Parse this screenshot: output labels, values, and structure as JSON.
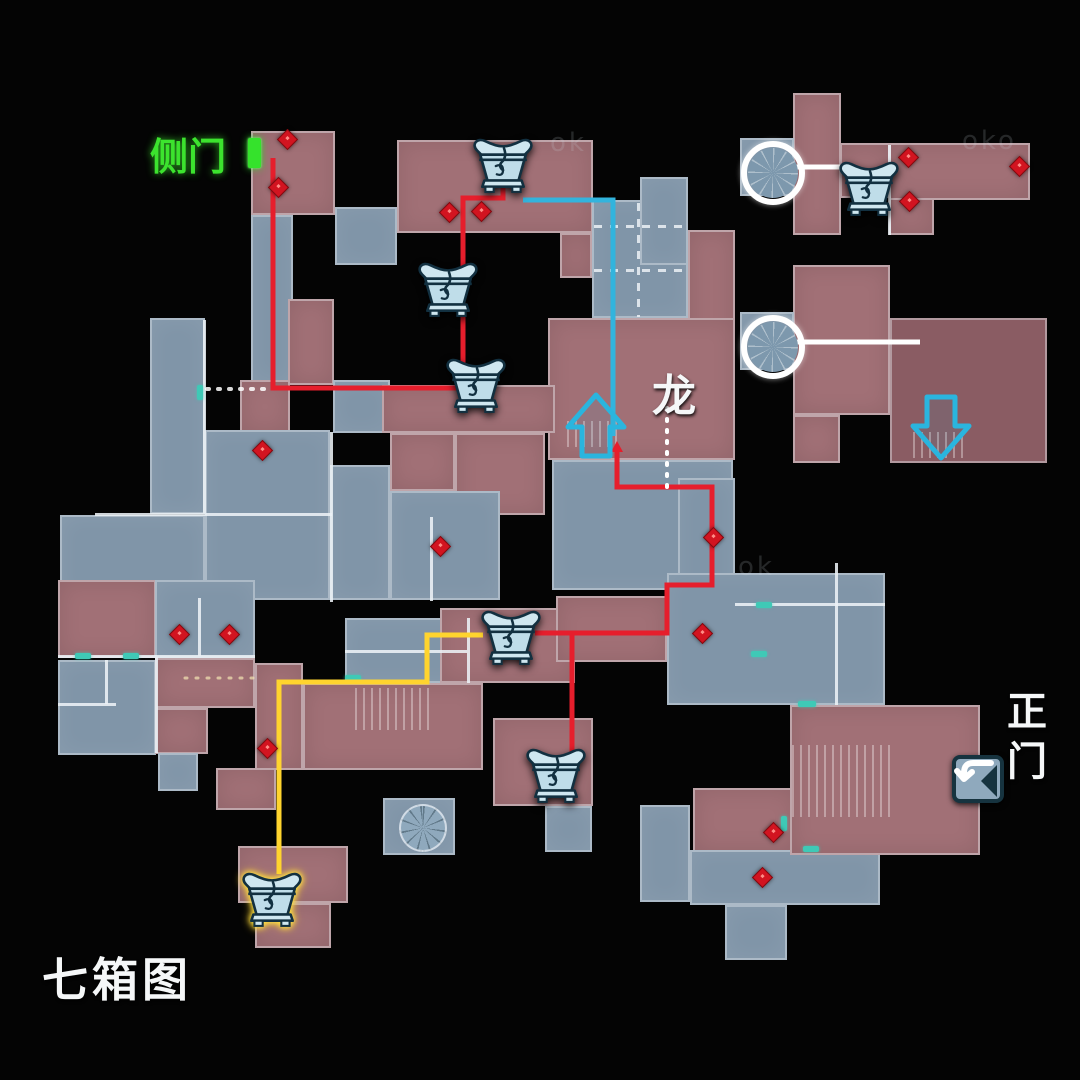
{
  "map": {
    "title": "七箱图",
    "labels": {
      "side_door": "侧门",
      "dragon": "龙",
      "main_gate": "正门"
    },
    "watermarks": [
      {
        "t": "oko",
        "x": 962,
        "y": 126
      },
      {
        "t": "ok",
        "x": 738,
        "y": 552
      },
      {
        "t": "ok",
        "x": 550,
        "y": 128
      }
    ],
    "colors": {
      "room_blue": "#8095a8",
      "room_red": "#a17076",
      "room_dark_red": "#8a5c63",
      "route_red": "#e61e2c",
      "route_yellow": "#ffd42e",
      "route_cyan": "#32b4dd",
      "route_white": "#ffffff",
      "door_green": "#35e22c",
      "marker_red": "#d21420",
      "door_teal": "#3fc9b6"
    },
    "rooms": [
      [
        251,
        131,
        84,
        84,
        "r"
      ],
      [
        251,
        215,
        42,
        168,
        "b"
      ],
      [
        288,
        299,
        46,
        86,
        "r"
      ],
      [
        335,
        207,
        62,
        58,
        "b"
      ],
      [
        150,
        318,
        55,
        196,
        "b"
      ],
      [
        240,
        380,
        50,
        53,
        "r"
      ],
      [
        333,
        380,
        57,
        53,
        "b"
      ],
      [
        397,
        140,
        196,
        93,
        "r"
      ],
      [
        560,
        233,
        32,
        45,
        "r"
      ],
      [
        592,
        200,
        96,
        118,
        "b"
      ],
      [
        640,
        177,
        48,
        88,
        "b"
      ],
      [
        688,
        230,
        47,
        118,
        "r"
      ],
      [
        548,
        318,
        187,
        142,
        "r"
      ],
      [
        382,
        385,
        173,
        48,
        "r"
      ],
      [
        390,
        433,
        65,
        58,
        "r"
      ],
      [
        455,
        433,
        90,
        82,
        "r"
      ],
      [
        205,
        430,
        125,
        170,
        "b"
      ],
      [
        330,
        465,
        60,
        135,
        "b"
      ],
      [
        390,
        491,
        110,
        109,
        "b"
      ],
      [
        60,
        515,
        145,
        85,
        "b"
      ],
      [
        552,
        460,
        181,
        130,
        "b"
      ],
      [
        678,
        478,
        57,
        127,
        "b"
      ],
      [
        667,
        573,
        218,
        132,
        "b"
      ],
      [
        58,
        580,
        98,
        78,
        "r"
      ],
      [
        155,
        580,
        100,
        78,
        "b"
      ],
      [
        58,
        660,
        98,
        95,
        "b"
      ],
      [
        155,
        658,
        100,
        50,
        "r"
      ],
      [
        155,
        708,
        53,
        46,
        "r"
      ],
      [
        255,
        663,
        48,
        107,
        "r"
      ],
      [
        158,
        753,
        40,
        38,
        "b"
      ],
      [
        345,
        618,
        122,
        65,
        "b"
      ],
      [
        440,
        608,
        135,
        75,
        "r"
      ],
      [
        556,
        596,
        111,
        66,
        "r"
      ],
      [
        303,
        683,
        180,
        87,
        "r"
      ],
      [
        216,
        768,
        60,
        42,
        "r"
      ],
      [
        383,
        798,
        72,
        57,
        "b"
      ],
      [
        493,
        718,
        100,
        88,
        "r"
      ],
      [
        545,
        806,
        47,
        46,
        "b"
      ],
      [
        640,
        805,
        50,
        97,
        "b"
      ],
      [
        693,
        788,
        103,
        64,
        "r"
      ],
      [
        690,
        850,
        190,
        55,
        "b"
      ],
      [
        725,
        905,
        62,
        55,
        "b"
      ],
      [
        790,
        705,
        190,
        150,
        "r"
      ],
      [
        793,
        93,
        48,
        142,
        "r"
      ],
      [
        840,
        143,
        50,
        55,
        "r"
      ],
      [
        889,
        143,
        141,
        57,
        "r"
      ],
      [
        889,
        198,
        45,
        37,
        "r"
      ],
      [
        793,
        265,
        97,
        150,
        "r"
      ],
      [
        793,
        415,
        47,
        48,
        "r"
      ],
      [
        890,
        318,
        157,
        145,
        "d"
      ],
      [
        740,
        138,
        54,
        58,
        "b"
      ],
      [
        740,
        312,
        54,
        58,
        "b"
      ],
      [
        238,
        846,
        110,
        57,
        "r"
      ],
      [
        255,
        903,
        76,
        45,
        "r"
      ]
    ],
    "walls": [
      [
        95,
        513,
        237,
        3
      ],
      [
        203,
        320,
        3,
        193
      ],
      [
        330,
        432,
        3,
        170
      ],
      [
        58,
        655,
        197,
        3
      ],
      [
        198,
        598,
        3,
        58
      ],
      [
        155,
        657,
        3,
        96
      ],
      [
        430,
        517,
        3,
        84
      ],
      [
        58,
        703,
        58,
        3
      ],
      [
        105,
        660,
        3,
        44
      ],
      [
        735,
        603,
        150,
        3
      ],
      [
        835,
        563,
        3,
        142
      ],
      [
        888,
        145,
        3,
        90
      ],
      [
        345,
        650,
        122,
        3
      ],
      [
        467,
        618,
        3,
        65
      ]
    ],
    "dashed_walls_h": [
      [
        594,
        225,
        92,
        3
      ],
      [
        594,
        269,
        92,
        3
      ]
    ],
    "dashed_walls_v": [
      [
        637,
        203,
        3,
        114
      ]
    ],
    "ladders": [
      [
        355,
        688,
        78,
        42
      ],
      [
        567,
        421,
        50,
        26
      ],
      [
        913,
        432,
        54,
        26
      ],
      [
        792,
        745,
        100,
        72
      ]
    ],
    "teal_doors": [
      [
        75,
        653,
        16,
        6
      ],
      [
        123,
        653,
        16,
        6
      ],
      [
        197,
        385,
        6,
        15
      ],
      [
        345,
        675,
        16,
        6
      ],
      [
        756,
        602,
        16,
        6
      ],
      [
        751,
        651,
        16,
        6
      ],
      [
        798,
        701,
        18,
        6
      ],
      [
        781,
        816,
        6,
        15
      ],
      [
        803,
        846,
        16,
        6
      ]
    ],
    "diamonds": [
      [
        287,
        139
      ],
      [
        278,
        187
      ],
      [
        449,
        212
      ],
      [
        481,
        211
      ],
      [
        908,
        157
      ],
      [
        1019,
        166
      ],
      [
        909,
        201
      ],
      [
        262,
        450
      ],
      [
        440,
        546
      ],
      [
        179,
        634
      ],
      [
        229,
        634
      ],
      [
        713,
        537
      ],
      [
        702,
        633
      ],
      [
        773,
        832
      ],
      [
        762,
        877
      ],
      [
        267,
        748
      ]
    ],
    "routes": {
      "red_a": "M273,158 L273,388 L480,388 M463,388 L463,198 L503,198 L503,170",
      "red_b": "M617,448 L617,487 L712,487 L712,585 L667,585 L667,633 L535,633 M572,633 L572,758",
      "yellow": "M483,635 L427,635 L427,682 L279,682 L279,874",
      "cyan": "M523,200 L613,200 L613,436",
      "white_1": "M792,167 L853,167",
      "white_2": "M792,342 L920,342",
      "dotted_1": "M667,408 L667,492",
      "dotted_2": "M207,389 L264,389",
      "dotted_3": "M185,678 L256,678"
    },
    "red_arrowhead_points": "611,452 623,452 617,441",
    "chests": [
      {
        "x": 503,
        "y": 167,
        "hl": false
      },
      {
        "x": 448,
        "y": 291,
        "hl": false
      },
      {
        "x": 476,
        "y": 387,
        "hl": false
      },
      {
        "x": 511,
        "y": 639,
        "hl": false
      },
      {
        "x": 556,
        "y": 777,
        "hl": false
      },
      {
        "x": 869,
        "y": 190,
        "hl": false
      },
      {
        "x": 272,
        "y": 901,
        "hl": true
      }
    ],
    "stair_circles": [
      [
        767,
        167
      ],
      [
        767,
        341
      ]
    ],
    "spiral_stair": [
      423,
      828
    ],
    "arrows": [
      {
        "x": 565,
        "y": 392,
        "dir": "up"
      },
      {
        "x": 910,
        "y": 393,
        "dir": "down"
      }
    ],
    "door_icon_pos": [
      951,
      751
    ],
    "green_marker": [
      248,
      138,
      13,
      30
    ]
  }
}
